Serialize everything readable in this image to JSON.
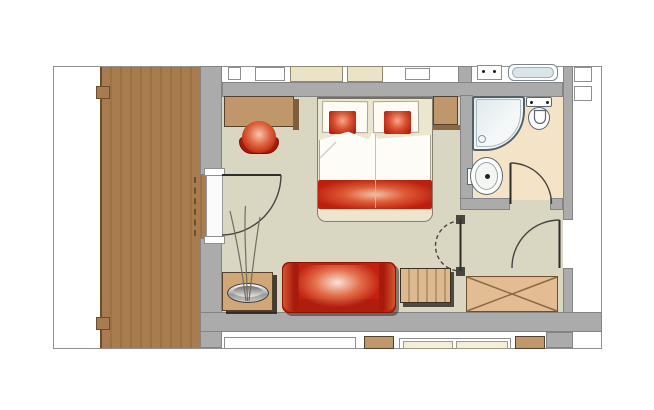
{
  "app": {
    "type": "floor-plan",
    "visible_text": []
  },
  "colors": {
    "outline": "#8f8f8f",
    "wall": "#ababab",
    "wall-edge": "#848484",
    "wood": "#a87c4e",
    "wood-line": "#9b7244",
    "wood-dark": "#6b4f2c",
    "floor": "#d9d7c2",
    "bath-floor": "#f4e3c6",
    "tan": "#c0966b",
    "tan-dark": "#55422a",
    "tan-edge": "#8a6a45",
    "bench-light": "#dcb98f",
    "bench-dark": "#b8946a",
    "wardrobe": "#e2bc92",
    "cream": "#ece6cf",
    "cream-dark": "#ebe3c5",
    "red": "#c3200f",
    "red-dark": "#a81a0b",
    "red-back": "#b01d0e",
    "fixture": "#5c666f",
    "tub-fill": "#d9e5e8",
    "shower-fill": "#eef4f5"
  },
  "plan": {
    "rooms": [
      {
        "name": "balcony-terrace"
      },
      {
        "name": "bedroom-living-area"
      },
      {
        "name": "bathroom"
      },
      {
        "name": "entry-hall"
      }
    ],
    "furniture": [
      "desk",
      "desk-chair",
      "double-bed",
      "bed-pillows",
      "red-bed-cushions",
      "red-bed-runner",
      "nightstand",
      "red-sofa",
      "side-table",
      "decorative-bowl-with-plant",
      "slatted-luggage-bench",
      "wardrobe-with-x"
    ],
    "fixtures": [
      "corner-shower",
      "toilet",
      "washbasin",
      "neighbor-bathtub-sliver",
      "neighbor-vanity-sliver"
    ],
    "doors": [
      "balcony-door",
      "bathroom-door",
      "hall-pivot-door",
      "entrance-door"
    ]
  }
}
